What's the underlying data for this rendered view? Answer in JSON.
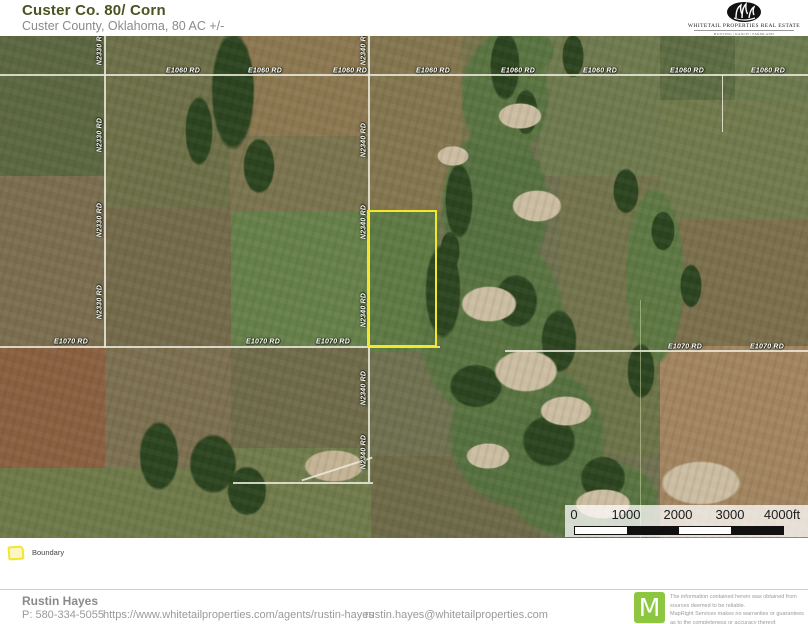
{
  "header": {
    "title": "Custer Co. 80/ Corn",
    "subtitle": "Custer County, Oklahoma, 80 AC +/-",
    "logo": {
      "name": "WHITETAIL PROPERTIES REAL ESTATE",
      "tagline": "HUNTING | RANCH | FARMLAND"
    }
  },
  "map": {
    "road_labels": [
      {
        "text": "E1060 RD",
        "x": 183,
        "y": 35,
        "o": "h"
      },
      {
        "text": "E1060 RD",
        "x": 265,
        "y": 35,
        "o": "h"
      },
      {
        "text": "E1060 RD",
        "x": 350,
        "y": 35,
        "o": "h"
      },
      {
        "text": "E1060 RD",
        "x": 433,
        "y": 35,
        "o": "h"
      },
      {
        "text": "E1060 RD",
        "x": 518,
        "y": 35,
        "o": "h"
      },
      {
        "text": "E1060 RD",
        "x": 600,
        "y": 35,
        "o": "h"
      },
      {
        "text": "E1060 RD",
        "x": 687,
        "y": 35,
        "o": "h"
      },
      {
        "text": "E1060 RD",
        "x": 768,
        "y": 35,
        "o": "h"
      },
      {
        "text": "E1070 RD",
        "x": 71,
        "y": 306,
        "o": "h"
      },
      {
        "text": "E1070 RD",
        "x": 263,
        "y": 306,
        "o": "h"
      },
      {
        "text": "E1070 RD",
        "x": 333,
        "y": 306,
        "o": "h"
      },
      {
        "text": "E1070 RD",
        "x": 685,
        "y": 311,
        "o": "h"
      },
      {
        "text": "E1070 RD",
        "x": 767,
        "y": 311,
        "o": "h"
      },
      {
        "text": "N2330 RD",
        "x": 100,
        "y": 12,
        "o": "v"
      },
      {
        "text": "N2330 RD",
        "x": 100,
        "y": 99,
        "o": "v"
      },
      {
        "text": "N2330 RD",
        "x": 100,
        "y": 184,
        "o": "v"
      },
      {
        "text": "N2330 RD",
        "x": 100,
        "y": 266,
        "o": "v"
      },
      {
        "text": "N2340 RD",
        "x": 364,
        "y": 12,
        "o": "v"
      },
      {
        "text": "N2340 RD",
        "x": 364,
        "y": 104,
        "o": "v"
      },
      {
        "text": "N2340 RD",
        "x": 364,
        "y": 186,
        "o": "v"
      },
      {
        "text": "N2340 RD",
        "x": 364,
        "y": 274,
        "o": "v"
      },
      {
        "text": "N2340 RD",
        "x": 364,
        "y": 352,
        "o": "v"
      },
      {
        "text": "N2340 RD",
        "x": 364,
        "y": 416,
        "o": "v"
      }
    ],
    "boundary_acres": "80 AC +/-"
  },
  "scalebar": {
    "ticks": [
      "0",
      "1000",
      "2000",
      "3000",
      "4000ft"
    ],
    "units": "ft"
  },
  "legend": {
    "items": [
      {
        "label": "Boundary",
        "swatch_color": "#f2e72c"
      }
    ]
  },
  "footer": {
    "agent": "Rustin Hayes",
    "phone": "P: 580-334-5055",
    "url": "https://www.whitetailproperties.com/agents/rustin-hayes",
    "email": "rustin.hayes@whitetailproperties.com",
    "attribution": {
      "logo_letter": "M",
      "lines": [
        "The information contained herein was obtained from",
        "sources deemed to be reliable.",
        "MapRight Services makes no warranties or guarantees",
        "as to the completeness or accuracy thereof."
      ]
    }
  },
  "colors": {
    "boundary_yellow": "#f2e72c",
    "boundary_fill": "#fbf6c3",
    "brand_green": "#8dc63f",
    "title_green": "#4b5322"
  }
}
